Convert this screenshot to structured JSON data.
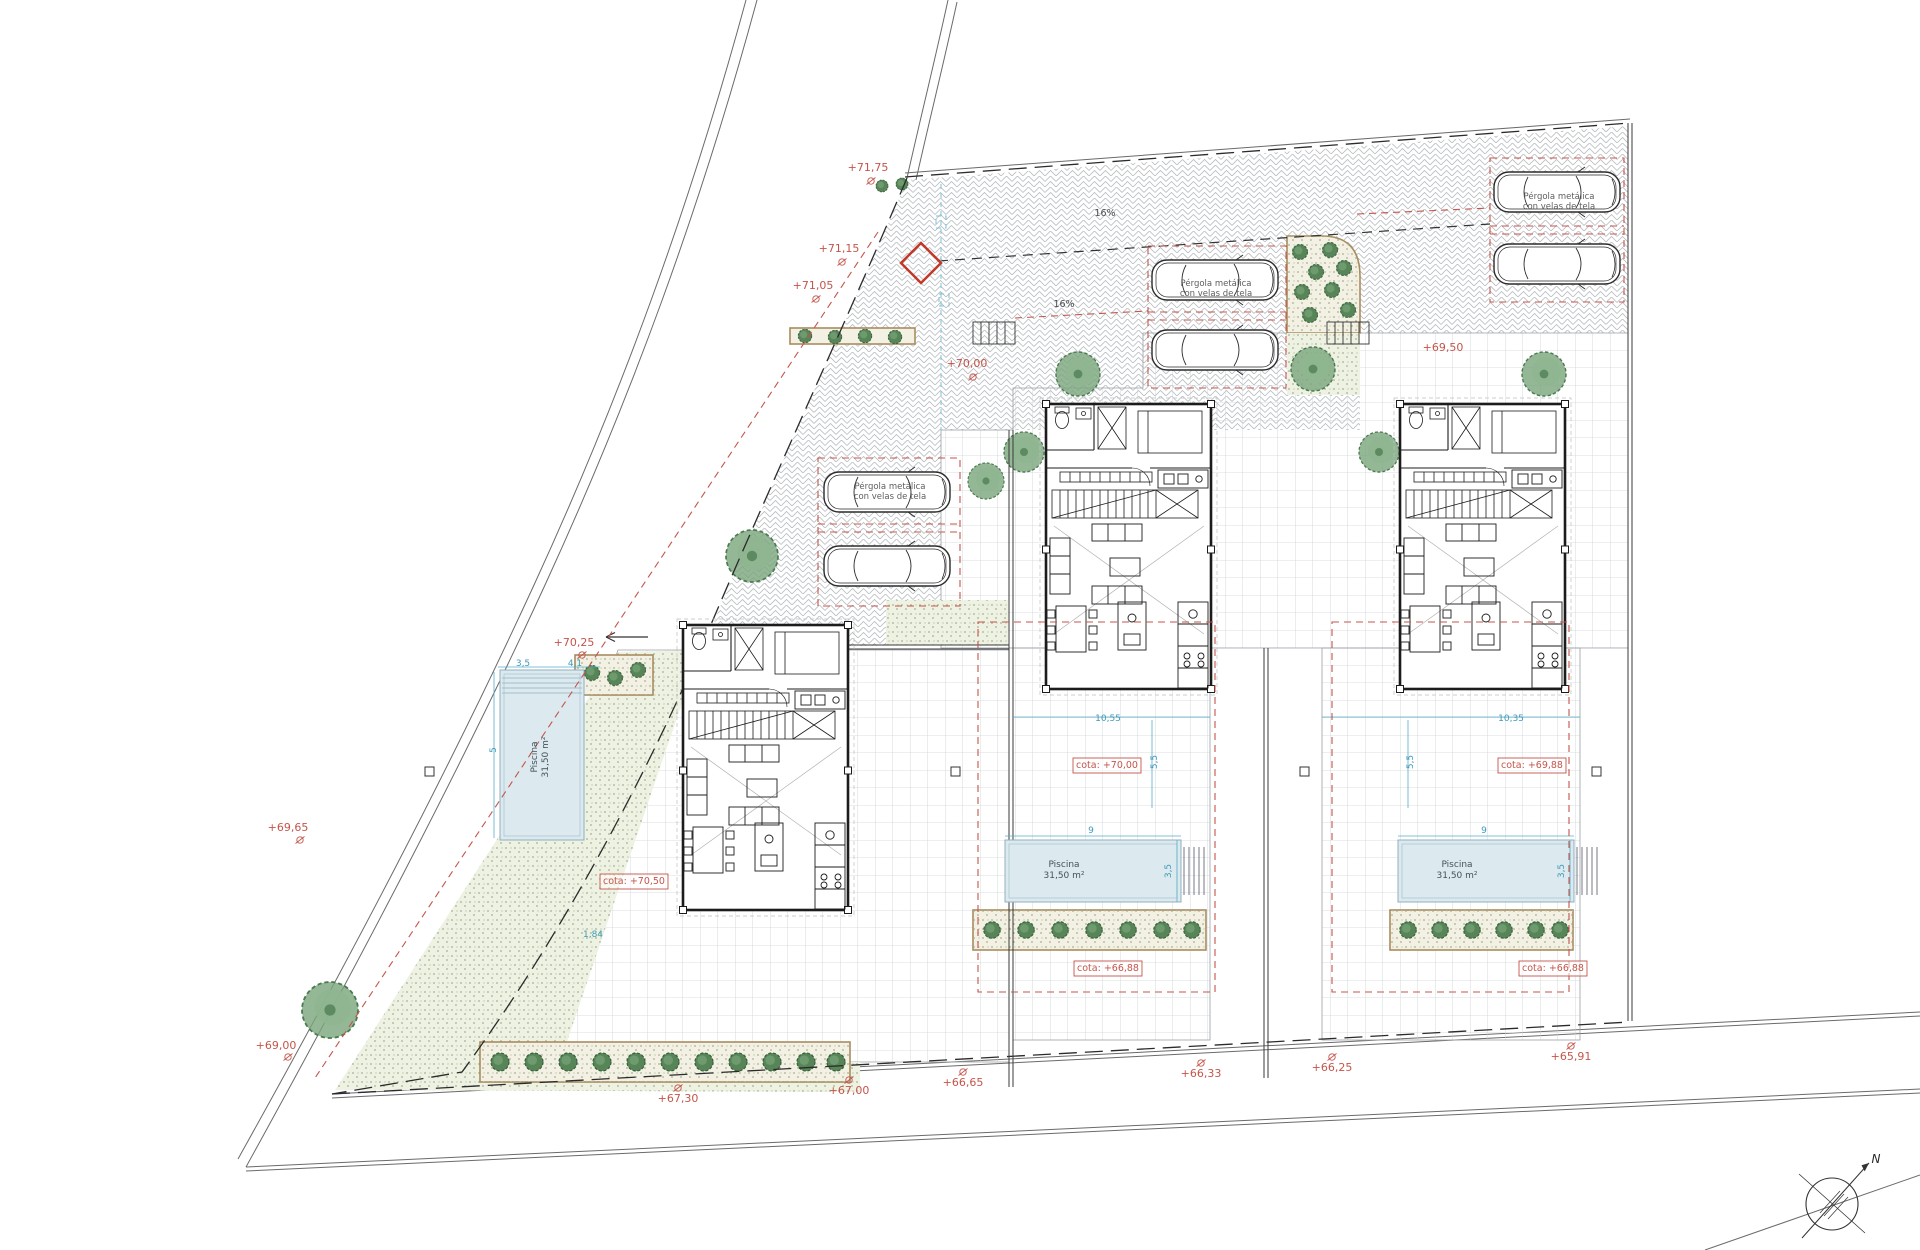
{
  "drawing": {
    "kind": "villa-site-plan",
    "colors": {
      "annotation_red": "#c4554b",
      "dimension_teal": "#3d9ab8",
      "pool_fill": "#dce9ef",
      "bush_green": "#578557",
      "tree_green": "#79a57c",
      "paving_gray": "#b6bcc0"
    }
  },
  "annotations": {
    "elevation": [
      {
        "text": "+71,75",
        "x": 868,
        "y": 171,
        "cls": "t-red",
        "marker": [
          3,
          10
        ]
      },
      {
        "text": "+71,15",
        "x": 839,
        "y": 252,
        "cls": "t-red",
        "marker": [
          3,
          10
        ]
      },
      {
        "text": "+71,05",
        "x": 813,
        "y": 289,
        "cls": "t-red",
        "marker": [
          3,
          10
        ]
      },
      {
        "text": "+70,25",
        "x": 574,
        "y": 646,
        "cls": "t-red",
        "marker": [
          8,
          9
        ]
      },
      {
        "text": "+70,00",
        "x": 967,
        "y": 367,
        "cls": "t-red",
        "marker": [
          6,
          10
        ]
      },
      {
        "text": "+69,65",
        "x": 288,
        "y": 831,
        "cls": "t-red",
        "marker": [
          12,
          9
        ]
      },
      {
        "text": "+69,00",
        "x": 276,
        "y": 1049,
        "cls": "t-red",
        "marker": [
          12,
          8
        ]
      },
      {
        "text": "+69,50",
        "x": 1443,
        "y": 351,
        "cls": "t-red"
      },
      {
        "text": "+67,30",
        "x": 678,
        "y": 1102,
        "cls": "t-red",
        "marker": [
          0,
          -14
        ]
      },
      {
        "text": "+67,00",
        "x": 849,
        "y": 1094,
        "cls": "t-red",
        "marker": [
          0,
          -14
        ]
      },
      {
        "text": "+66,65",
        "x": 963,
        "y": 1086,
        "cls": "t-red",
        "marker": [
          0,
          -14
        ]
      },
      {
        "text": "+66,33",
        "x": 1201,
        "y": 1077,
        "cls": "t-red",
        "marker": [
          0,
          -14
        ]
      },
      {
        "text": "+66,25",
        "x": 1332,
        "y": 1071,
        "cls": "t-red",
        "marker": [
          0,
          -14
        ]
      },
      {
        "text": "+65,91",
        "x": 1571,
        "y": 1060,
        "cls": "t-red",
        "marker": [
          0,
          -14
        ]
      }
    ],
    "cota": [
      {
        "text": "cota: +70,50",
        "x": 634,
        "y": 884,
        "cls": "t-cota",
        "box": true
      },
      {
        "text": "cota: +70,00",
        "x": 1107,
        "y": 768,
        "cls": "t-cota",
        "box": true
      },
      {
        "text": "cota: +69,88",
        "x": 1532,
        "y": 768,
        "cls": "t-cota",
        "box": true
      },
      {
        "text": "cota: +66,88",
        "x": 1108,
        "y": 971,
        "cls": "t-cota",
        "box": true
      },
      {
        "text": "cota: +66,88",
        "x": 1553,
        "y": 971,
        "cls": "t-cota",
        "box": true
      }
    ],
    "pergola": [
      {
        "lines": [
          "Pérgola metálica",
          "con velas de tela"
        ],
        "x": 890,
        "y": 489,
        "lh": 10,
        "cls": "t-gray"
      },
      {
        "lines": [
          "Pérgola metálica",
          "con velas de tela"
        ],
        "x": 1216,
        "y": 286,
        "lh": 10,
        "cls": "t-gray"
      },
      {
        "lines": [
          "Pérgola metálica",
          "con velas de tela"
        ],
        "x": 1559,
        "y": 199,
        "lh": 10,
        "cls": "t-gray"
      }
    ],
    "pool": [
      {
        "lines": [
          "Piscina",
          "31,50 m²"
        ],
        "x": 1064,
        "y": 867,
        "lh": 11,
        "cls": "t-pool"
      },
      {
        "lines": [
          "Piscina",
          "31,50 m²"
        ],
        "x": 1457,
        "y": 867,
        "lh": 11,
        "cls": "t-pool"
      },
      {
        "lines": [
          "Piscina",
          "31,50 m²"
        ],
        "x": 537,
        "y": 757,
        "lh": 11,
        "cls": "t-pool",
        "rot": -90
      }
    ],
    "slope": [
      {
        "text": "16%",
        "x": 1105,
        "y": 216,
        "cls": "t-slope"
      },
      {
        "text": "16%",
        "x": 1064,
        "y": 307,
        "cls": "t-slope"
      }
    ],
    "dims": [
      {
        "text": "10,55",
        "x": 1108,
        "y": 721,
        "cls": "t-dim"
      },
      {
        "text": "10,35",
        "x": 1511,
        "y": 721,
        "cls": "t-dim"
      },
      {
        "text": "5,5",
        "x": 1157,
        "y": 762,
        "cls": "t-dim",
        "rot": -90
      },
      {
        "text": "5,5",
        "x": 1413,
        "y": 762,
        "cls": "t-dim",
        "rot": -90
      },
      {
        "text": "9",
        "x": 1091,
        "y": 833,
        "cls": "t-dim"
      },
      {
        "text": "3,5",
        "x": 1171,
        "y": 871,
        "cls": "t-dim",
        "rot": -90
      },
      {
        "text": "9",
        "x": 1484,
        "y": 833,
        "cls": "t-dim"
      },
      {
        "text": "3,5",
        "x": 1564,
        "y": 871,
        "cls": "t-dim",
        "rot": -90
      },
      {
        "text": "3,5",
        "x": 523,
        "y": 666,
        "cls": "t-dim"
      },
      {
        "text": "4,1",
        "x": 575,
        "y": 666,
        "cls": "t-dim"
      },
      {
        "text": "5",
        "x": 496,
        "y": 750,
        "cls": "t-dim",
        "rot": -90
      },
      {
        "text": "1,84",
        "x": 593,
        "y": 937,
        "cls": "t-dim"
      }
    ],
    "compass": [
      {
        "text": "N",
        "x": 1876,
        "y": 1163,
        "cls": "t-compass",
        "name": "north-label"
      }
    ]
  }
}
